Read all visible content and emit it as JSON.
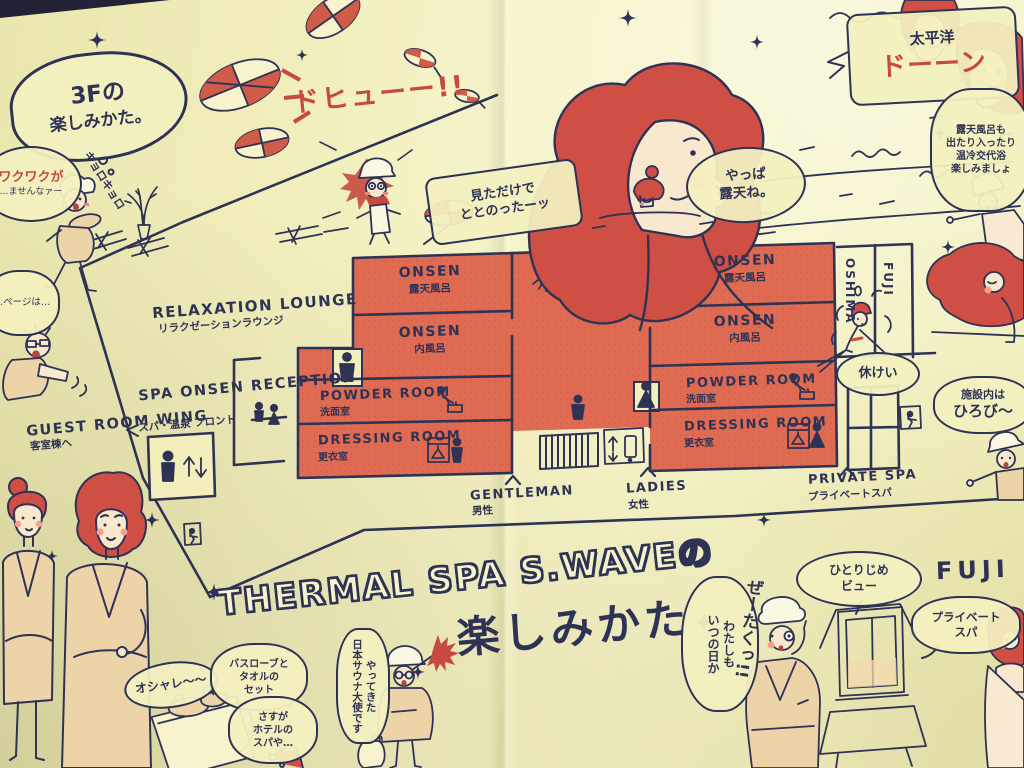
{
  "colors": {
    "paper": "#f2efbc",
    "salmon": "#e06b53",
    "ink": "#2e3254",
    "accent_red": "#c8493f",
    "skin": "#f8e8cd",
    "robe": "#ecd3a8"
  },
  "corner_bubble": {
    "line1": "3Fの",
    "line2": "楽しみかた。"
  },
  "title": {
    "line1": "THERMAL SPA S.WAVEの",
    "line2": "楽しみかた"
  },
  "plan": {
    "lounge": {
      "en": "RELAXATION LOUNGE",
      "jp": "リラクゼーションラウンジ"
    },
    "reception": {
      "en": "SPA ONSEN\nRECEPTION",
      "jp": "スパ・温泉 フロント"
    },
    "guest_wing": {
      "en": "GUEST ROOM WING",
      "jp": "客室棟へ"
    },
    "mens": [
      {
        "en": "ONSEN",
        "jp": "露天風呂"
      },
      {
        "en": "ONSEN",
        "jp": "内風呂"
      },
      {
        "en": "POWDER ROOM",
        "jp": "洗面室"
      },
      {
        "en": "DRESSING ROOM",
        "jp": "更衣室"
      }
    ],
    "ladies": [
      {
        "en": "ONSEN",
        "jp": "露天風呂"
      },
      {
        "en": "ONSEN",
        "jp": "内風呂"
      },
      {
        "en": "POWDER ROOM",
        "jp": "洗面室"
      },
      {
        "en": "DRESSING ROOM",
        "jp": "更衣室"
      }
    ],
    "right_rooms": [
      "OSHIMA",
      "FUJI"
    ],
    "entrances": [
      {
        "en": "GENTLEMAN",
        "jp": "男性"
      },
      {
        "en": "LADIES",
        "jp": "女性"
      },
      {
        "en": "PRIVATE SPA",
        "jp": "プライベートスパ"
      }
    ]
  },
  "speech": {
    "waku_red": "ワクワクが",
    "waku_rest": "…ませんなァー",
    "kyoro": "キョロキョロ",
    "hyu": "ドヒューー!!",
    "mita": "見ただけで\nととのったーッ",
    "taiheiyo": "太平洋",
    "don": "ドーーン",
    "yappa": "やっぱ\n露天ね。",
    "kyukei": "休けい",
    "roten": "露天風呂も\n出たり入ったり\n温冷交代浴\n楽しみましょ",
    "hirobiro1": "施設内は",
    "hirobiro2": "ひろび〜",
    "hitorijime": "ひとりじめ\nビュー",
    "fuji_hand": "FUJI",
    "private_spa_hand": "プライベート\nスパ",
    "watashimo": "わたしも\nいつの日か",
    "zeitaku": "ぜーたくっ!!",
    "oshare": "オシャレ〜〜",
    "bathrobe": "バスローブと\nタオルの\nセット",
    "sasuga": "さすが\nホテルの\nスパや…",
    "taishi": "やってきた\n日本サウナ大使です",
    "page_frag": "…ページは…"
  }
}
